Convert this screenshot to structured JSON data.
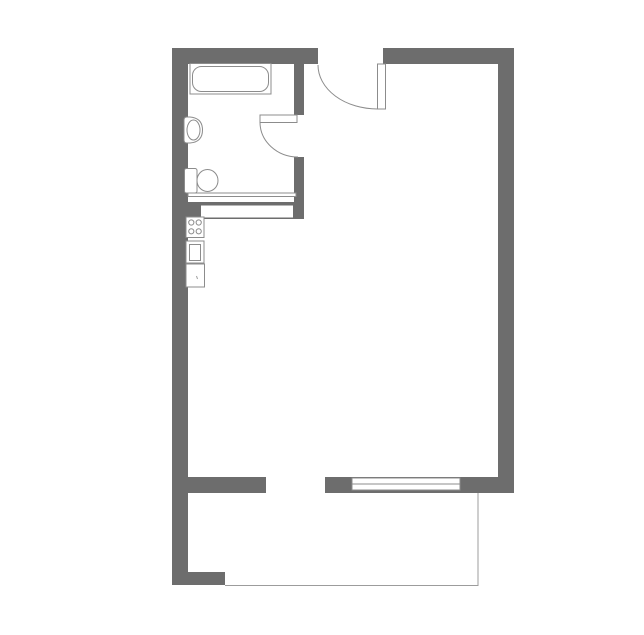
{
  "plan": {
    "canvas": {
      "width": 644,
      "height": 635,
      "background": "#ffffff"
    },
    "colors": {
      "wall": "#6d6d6d",
      "stroke": "#8c8c8c",
      "thin": "#9c9c9c",
      "white": "#ffffff",
      "none": "none"
    },
    "layers": [
      {
        "name": "walls",
        "items": [
          {
            "name": "wall-top-left",
            "type": "rect",
            "x": 172,
            "y": 48,
            "w": 146,
            "h": 16,
            "fill": "wall"
          },
          {
            "name": "wall-top-right",
            "type": "rect",
            "x": 383,
            "y": 48,
            "w": 131,
            "h": 16,
            "fill": "wall"
          },
          {
            "name": "wall-left",
            "type": "rect",
            "x": 172,
            "y": 48,
            "w": 16,
            "h": 537,
            "fill": "wall"
          },
          {
            "name": "wall-left-foot",
            "type": "rect",
            "x": 172,
            "y": 572,
            "w": 53,
            "h": 13,
            "fill": "wall"
          },
          {
            "name": "wall-right",
            "type": "rect",
            "x": 498,
            "y": 48,
            "w": 16,
            "h": 445,
            "fill": "wall"
          },
          {
            "name": "wall-bottom-left",
            "type": "rect",
            "x": 172,
            "y": 477,
            "w": 94,
            "h": 16,
            "fill": "wall"
          },
          {
            "name": "wall-bottom-mid",
            "type": "rect",
            "x": 325,
            "y": 477,
            "w": 27,
            "h": 16,
            "fill": "wall"
          },
          {
            "name": "wall-bottom-window-back",
            "type": "rect",
            "x": 352,
            "y": 477,
            "w": 108,
            "h": 16,
            "fill": "wall"
          },
          {
            "name": "wall-bottom-right",
            "type": "rect",
            "x": 460,
            "y": 477,
            "w": 54,
            "h": 16,
            "fill": "wall"
          },
          {
            "name": "wall-partition-upper",
            "type": "rect",
            "x": 294,
            "y": 64,
            "w": 10,
            "h": 51,
            "fill": "wall"
          },
          {
            "name": "wall-partition-lower",
            "type": "rect",
            "x": 294,
            "y": 157,
            "w": 10,
            "h": 62,
            "fill": "wall"
          },
          {
            "name": "wall-bath-kitchen-band",
            "type": "rect",
            "x": 186,
            "y": 202,
            "w": 118,
            "h": 17,
            "fill": "wall"
          }
        ]
      },
      {
        "name": "openings",
        "items": [
          {
            "name": "bath-wall-slot",
            "type": "rect",
            "x": 201,
            "y": 205.5,
            "w": 92,
            "h": 12,
            "fill": "white"
          },
          {
            "name": "bath-thin-partition",
            "type": "rect",
            "x": 188,
            "y": 193,
            "w": 108,
            "h": 3.5,
            "fill": "white",
            "stroke": "stroke"
          },
          {
            "name": "window-frame",
            "type": "rect",
            "x": 352,
            "y": 478,
            "w": 108,
            "h": 12,
            "fill": "white",
            "stroke": "stroke"
          },
          {
            "name": "window-mullion",
            "type": "line",
            "x1": 352,
            "y1": 484,
            "x2": 460,
            "y2": 484,
            "stroke": "stroke"
          }
        ]
      },
      {
        "name": "doors",
        "items": [
          {
            "name": "entrance-door-swing",
            "type": "path",
            "d": "M 318 65 A 59.5 44 0 0 0 377.5 109",
            "fill": "none",
            "stroke": "stroke"
          },
          {
            "name": "entrance-door-leaf",
            "type": "rect",
            "x": 377.5,
            "y": 64,
            "w": 8,
            "h": 45,
            "fill": "white",
            "stroke": "stroke"
          },
          {
            "name": "bathroom-door-swing",
            "type": "path",
            "d": "M 260 122 A 38 35 0 0 0 298 157",
            "fill": "none",
            "stroke": "stroke"
          },
          {
            "name": "bathroom-door-leaf",
            "type": "rect",
            "x": 260,
            "y": 115,
            "w": 37,
            "h": 7.5,
            "fill": "white",
            "stroke": "stroke"
          }
        ]
      },
      {
        "name": "bathroom-fixtures",
        "items": [
          {
            "name": "bathtub-frame",
            "type": "rect",
            "x": 190,
            "y": 63.5,
            "w": 81,
            "h": 30.5,
            "fill": "white",
            "stroke": "stroke"
          },
          {
            "name": "bathtub-basin",
            "type": "rect",
            "x": 192.5,
            "y": 66.5,
            "w": 76,
            "h": 25,
            "rx": 9,
            "fill": "white",
            "stroke": "stroke"
          },
          {
            "name": "washbasin-body",
            "type": "path",
            "d": "M 184 120 Q 184 117 187 117 L 190 117 Q 202.5 118 202.5 130 Q 202.5 142 190 143 L 187 143 Q 184 143 184 140 Z",
            "fill": "white",
            "stroke": "stroke"
          },
          {
            "name": "washbasin-bowl",
            "type": "ellipse",
            "cx": 193.5,
            "cy": 130,
            "rx": 6.5,
            "ry": 10,
            "fill": "white",
            "stroke": "stroke"
          },
          {
            "name": "toilet-tank",
            "type": "rect",
            "x": 184.5,
            "y": 168.5,
            "w": 12.5,
            "h": 24.5,
            "rx": 2,
            "fill": "white",
            "stroke": "stroke"
          },
          {
            "name": "toilet-bowl",
            "type": "ellipse",
            "cx": 207.5,
            "cy": 180.5,
            "rx": 10.5,
            "ry": 11,
            "fill": "white",
            "stroke": "stroke"
          }
        ]
      },
      {
        "name": "kitchen-fixtures",
        "items": [
          {
            "name": "cooktop",
            "type": "rect",
            "x": 186,
            "y": 217,
            "w": 18,
            "h": 20.5,
            "fill": "white",
            "stroke": "stroke"
          },
          {
            "name": "burner-top-left",
            "type": "circle",
            "cx": 191.3,
            "cy": 222.5,
            "r": 2.6,
            "fill": "white",
            "stroke": "stroke"
          },
          {
            "name": "burner-top-right",
            "type": "circle",
            "cx": 198.7,
            "cy": 222.5,
            "r": 2.6,
            "fill": "white",
            "stroke": "stroke"
          },
          {
            "name": "burner-bottom-left",
            "type": "circle",
            "cx": 191.3,
            "cy": 231.3,
            "r": 2.6,
            "fill": "white",
            "stroke": "stroke"
          },
          {
            "name": "burner-bottom-right",
            "type": "circle",
            "cx": 198.7,
            "cy": 231.3,
            "r": 2.6,
            "fill": "white",
            "stroke": "stroke"
          },
          {
            "name": "kitchen-sink",
            "type": "rect",
            "x": 186,
            "y": 241,
            "w": 18,
            "h": 22,
            "fill": "white",
            "stroke": "stroke"
          },
          {
            "name": "kitchen-sink-basin",
            "type": "rect",
            "x": 189.5,
            "y": 244.5,
            "w": 11,
            "h": 16,
            "fill": "white",
            "stroke": "stroke"
          },
          {
            "name": "kitchen-counter",
            "type": "rect",
            "x": 186,
            "y": 264,
            "w": 18.5,
            "h": 23,
            "fill": "white",
            "stroke": "stroke"
          },
          {
            "name": "kitchen-counter-mark",
            "type": "line",
            "x1": 196.5,
            "y1": 276,
            "x2": 197.5,
            "y2": 279,
            "stroke": "thin"
          }
        ]
      },
      {
        "name": "balcony",
        "items": [
          {
            "name": "balcony-edge-right",
            "type": "line",
            "x1": 478,
            "y1": 493,
            "x2": 478,
            "y2": 585.5,
            "stroke": "thin"
          },
          {
            "name": "balcony-edge-bottom",
            "type": "line",
            "x1": 225,
            "y1": 585.5,
            "x2": 478.5,
            "y2": 585.5,
            "stroke": "thin"
          }
        ]
      }
    ]
  }
}
